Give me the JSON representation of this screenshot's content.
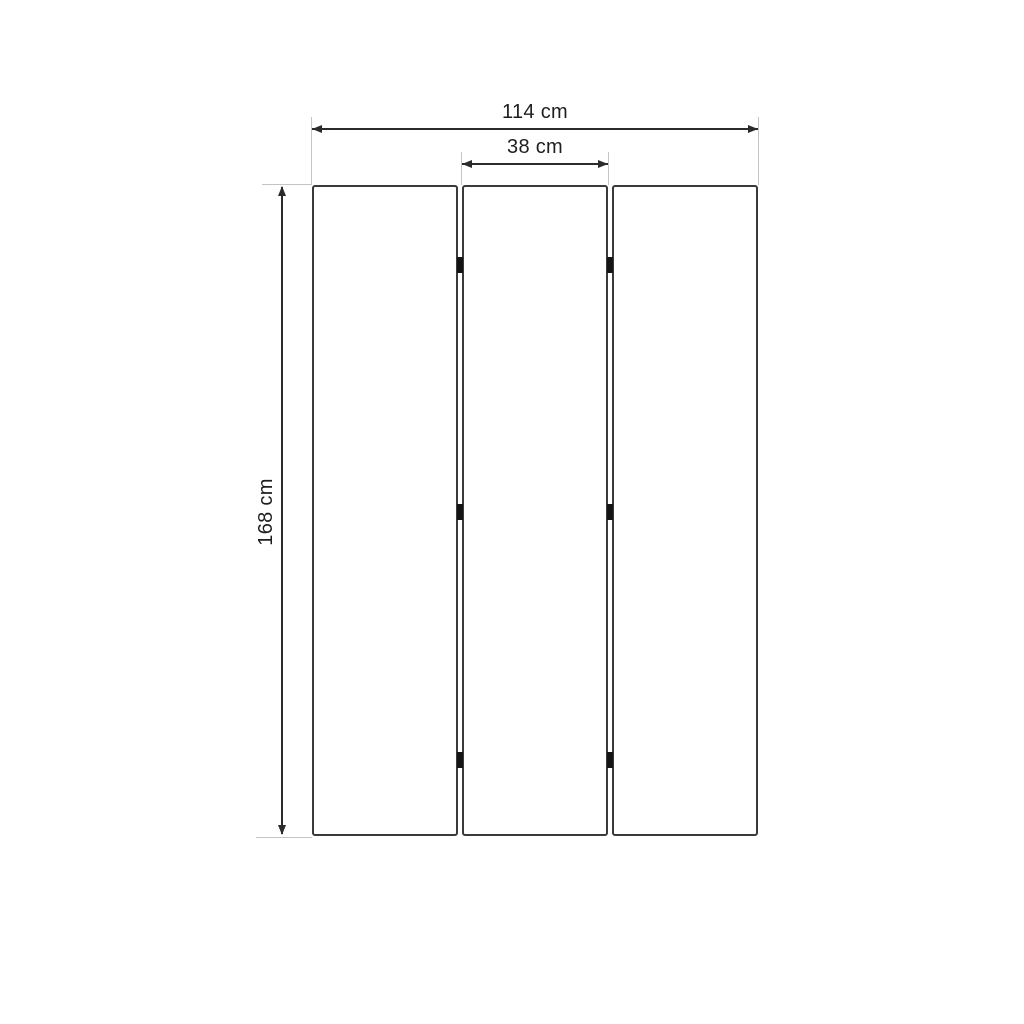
{
  "diagram": {
    "type": "furniture-dimension-drawing",
    "subject": "three-panel folding screen (room divider), front view",
    "panels": {
      "count": 3
    },
    "hinges": {
      "count": 6,
      "rows": 3,
      "columns": 2
    },
    "dimensions": {
      "total_width": {
        "label": "114 cm",
        "value": 114,
        "unit": "cm"
      },
      "panel_width": {
        "label": "38 cm",
        "value": 38,
        "unit": "cm"
      },
      "height": {
        "label": "168 cm",
        "value": 168,
        "unit": "cm"
      }
    },
    "colors": {
      "background": "#ffffff",
      "panel_border": "#3a3a3a",
      "dimension_line": "#2b2b2b",
      "extension_line": "#c4c4c4",
      "hinge": "#141414",
      "text": "#1e1e1e"
    }
  }
}
